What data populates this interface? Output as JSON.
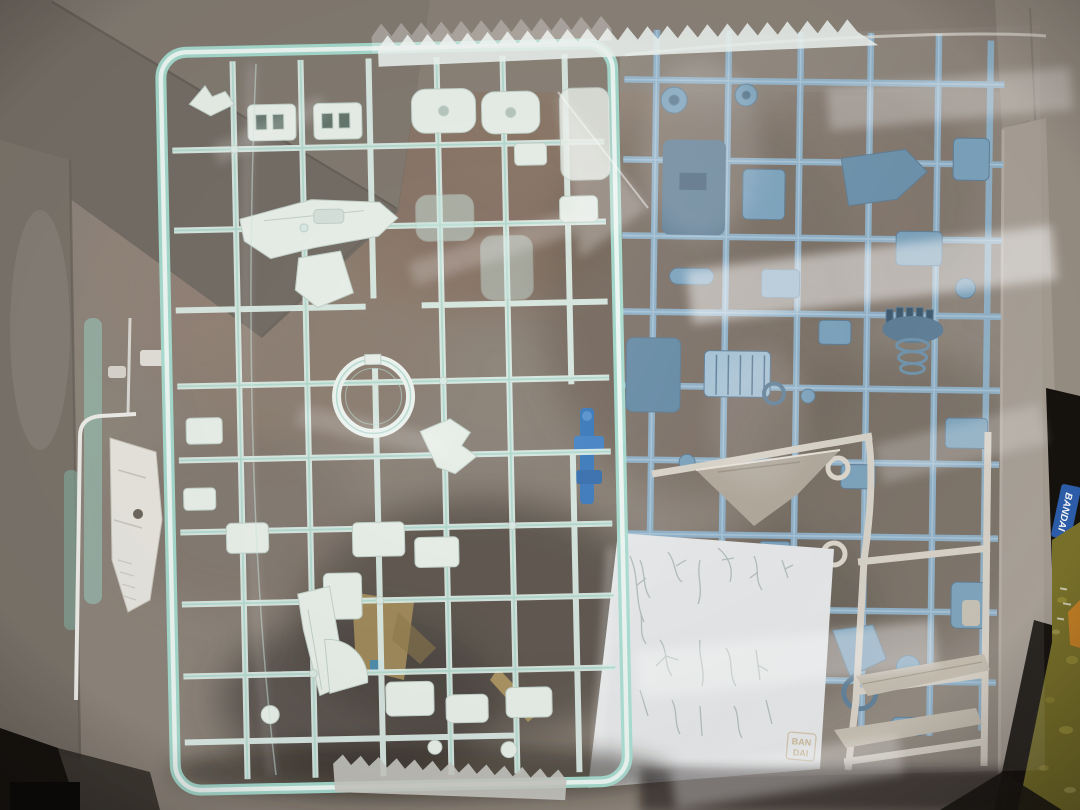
{
  "photo": {
    "alt": "Opened cardboard model-kit box seen from above containing plastic part runners (sprues) sealed in clear bags: a clear mint-tinted runner with white parts on the left, a powder-blue runner on the right, an ivory runner with wing parts and a white decal backing sheet at lower right"
  },
  "texts": {
    "decal_stamp_line1": "BAN",
    "decal_stamp_line2": "DAI",
    "side_logo": "BANDAI"
  },
  "colors": {
    "background_dark": "#16120e",
    "box_floor": "#8f867c",
    "box_wall": "#7c756c",
    "box_wall_right": "#a79e94",
    "clear_sprue_tint": "#a8ded2",
    "clear_sprue_part": "#e9efe9",
    "blue_sprue": "#8fb3cc",
    "blue_sprue_part": "#7aa2bd",
    "white_sprue": "#d9d3c8",
    "decal_paper": "#e7e9ea",
    "decal_marks": "#8fa29a",
    "bag_highlight": "#ffffff",
    "outside_item_olive": "#7d752c",
    "logo_blue": "#2e5fae",
    "stamp_tan": "#c9b795"
  }
}
